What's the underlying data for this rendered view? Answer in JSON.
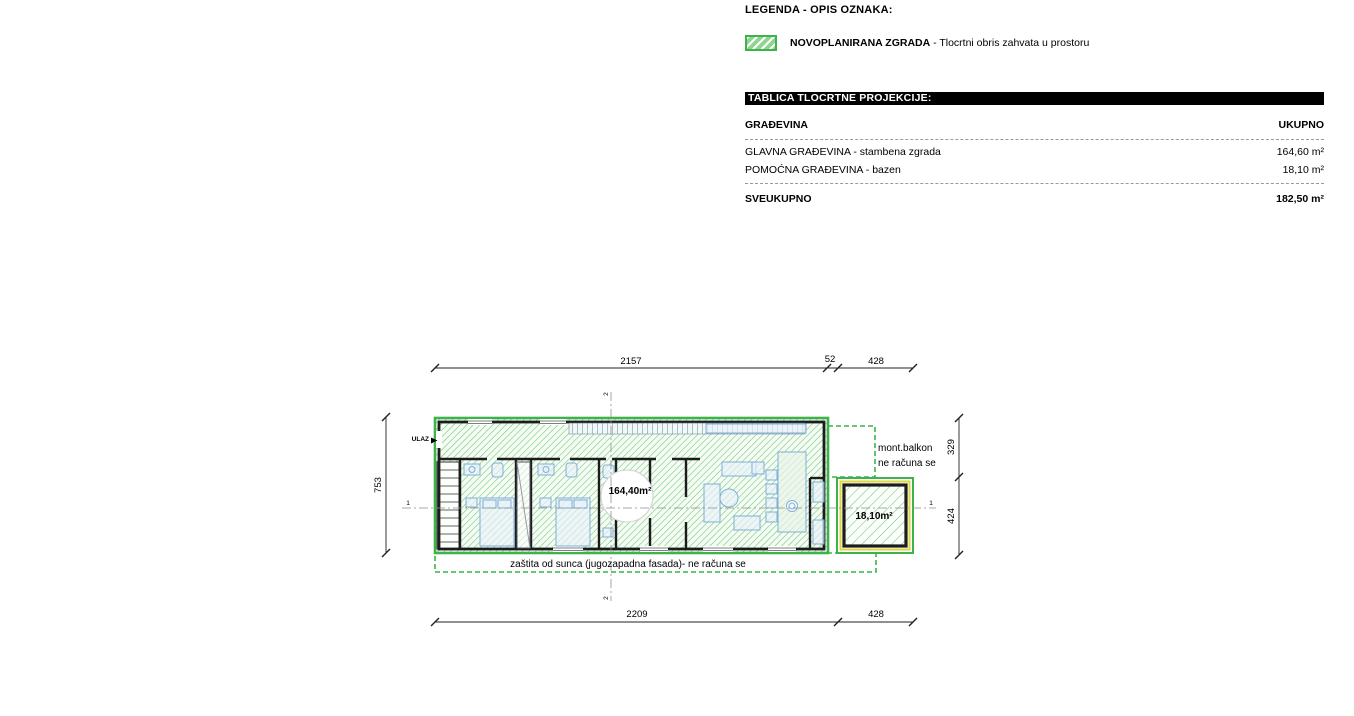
{
  "legend": {
    "title": "LEGENDA - OPIS OZNAKA:",
    "item_name": "NOVOPLANIRANA ZGRADA",
    "item_description": " - Tlocrtni obris zahvata u prostoru"
  },
  "table": {
    "header": "TABLICA TLOCRTNE PROJEKCIJE:",
    "col_name": "GRAĐEVINA",
    "col_total": "UKUPNO",
    "rows": [
      {
        "label": "GLAVNA GRAĐEVINA - stambena zgrada",
        "value": "164,60 m²"
      },
      {
        "label": "POMOĆNA GRAĐEVINA - bazen",
        "value": "18,10 m²"
      }
    ],
    "total_label": "SVEUKUPNO",
    "total_value": "182,50 m²"
  },
  "plan": {
    "labels": {
      "entrance": "ULAZ",
      "main_area": "164,40m²",
      "pool_area": "18,10m²",
      "balcony_line1": "mont.balkon",
      "balcony_line2": "ne računa se",
      "sun_protection": "zaštita od sunca (jugozapadna fasada)- ne računa se"
    },
    "dims": {
      "top_main": "2157",
      "top_small": "52",
      "top_right": "428",
      "bottom_main": "2209",
      "bottom_right": "428",
      "left": "753",
      "right_upper": "329",
      "right_lower": "424"
    },
    "axes": {
      "axis1": "1",
      "axis2": "2"
    },
    "colors": {
      "outline_green": "#3cb44b",
      "hatch_green": "#62c462",
      "pool_edge_yellow": "#ddd83a",
      "furniture_blue": "#7fb0d6",
      "wall_black": "#1c1c1c"
    }
  }
}
